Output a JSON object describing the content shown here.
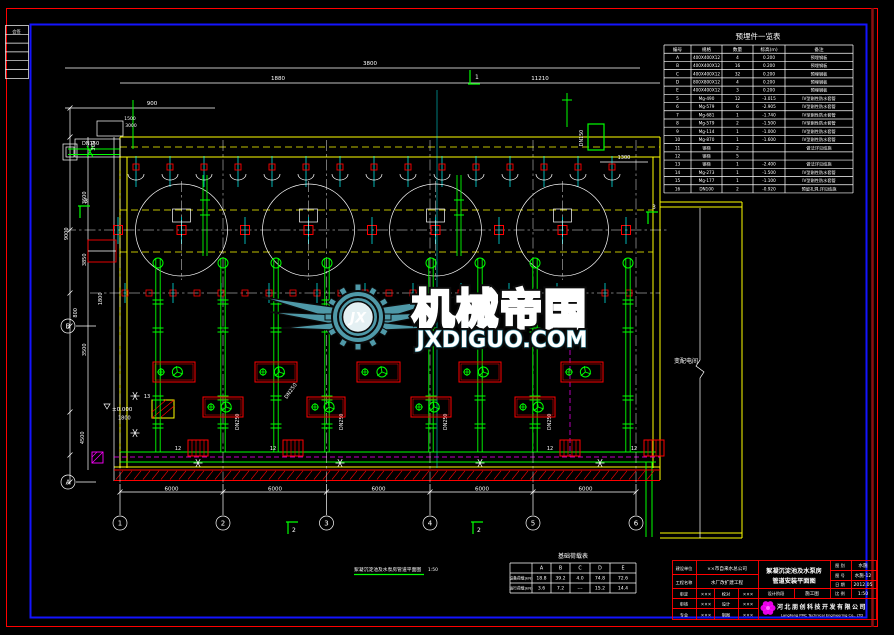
{
  "signoff_strip": {
    "rows": [
      "会签",
      "",
      "",
      "",
      "",
      ""
    ]
  },
  "parts_table": {
    "title": "预埋件一览表",
    "columns": [
      "编号",
      "规格",
      "数量",
      "标高(m)",
      "备注"
    ],
    "rows": [
      [
        "A",
        "400X400X12",
        "4",
        "0.200",
        "预埋钢板"
      ],
      [
        "B",
        "400X400X12",
        "16",
        "0.200",
        "预埋钢板"
      ],
      [
        "C",
        "400X400X12",
        "32",
        "0.200",
        "预埋钢板"
      ],
      [
        "D",
        "800X800X12",
        "4",
        "0.200",
        "预埋钢板"
      ],
      [
        "E",
        "400X400X12",
        "3",
        "0.200",
        "预埋钢板"
      ],
      [
        "5",
        "Mg-490",
        "12",
        "-3.015",
        "IV型刚性防水套管"
      ],
      [
        "6",
        "Mg-579",
        "6",
        "-2.905",
        "IV型刚性防水套管"
      ],
      [
        "7",
        "Mg-681",
        "1",
        "-1.740",
        "IV型刚性防水套管"
      ],
      [
        "8",
        "Mg-579",
        "2",
        "-1.500",
        "IV型刚性防水套管"
      ],
      [
        "9",
        "Mg-114",
        "1",
        "-1.000",
        "IV型刚性防水套管"
      ],
      [
        "10",
        "Mg-870",
        "1",
        "-1.600",
        "IV型刚性防水套管"
      ],
      [
        "11",
        "钢梯",
        "2",
        "",
        "做法详见结施"
      ],
      [
        "12",
        "钢梯",
        "5",
        "",
        ""
      ],
      [
        "13",
        "钢梯",
        "1",
        "-2.400",
        "做法详见结施"
      ],
      [
        "14",
        "Mg-273",
        "1",
        "-1.500",
        "IV型刚性防水套管"
      ],
      [
        "15",
        "Mg-177",
        "1",
        "-1.100",
        "IV型刚性防水套管"
      ],
      [
        "16",
        "DN100",
        "2",
        "-0.920",
        "预留孔洞,详见结施"
      ]
    ]
  },
  "load_table": {
    "title": "基础荷载表",
    "columns": [
      "",
      "A",
      "B",
      "C",
      "D",
      "E"
    ],
    "rows": [
      [
        "设备荷载(kN)",
        "18.8",
        "39.2",
        "4.0",
        "74.8",
        "72.6"
      ],
      [
        "运行荷载(kN)",
        "3.6",
        "7.2",
        "---",
        "15.2",
        "14.4"
      ]
    ]
  },
  "watermark": {
    "brand": "机械帝国",
    "domain": "JXDIGUO.COM",
    "monogram": "JX",
    "color": "#2f8296"
  },
  "drawing": {
    "caption": "絮凝沉淀池及水泵房管道平面图",
    "scale": "1:50",
    "room_label": "变配电间",
    "elevation": "±0.000",
    "elevation_dim": "1800",
    "labels": {
      "inlet_pipe": "DN150",
      "casing_pipe": "DN150",
      "suction_pipe": "DN250",
      "discharge_pipe": "DN250",
      "ladder": "12",
      "stair": "13"
    },
    "dims": {
      "top": "3800",
      "upper_left": "1880",
      "upper_right": "11210",
      "platform": "900",
      "left_small": [
        "1500",
        "3000"
      ],
      "left": [
        "300",
        "3600",
        "9000",
        "3850",
        "1800",
        "800",
        "3500",
        "4500"
      ],
      "right": "1300",
      "bottom": [
        "6000",
        "6000",
        "6000",
        "6000",
        "6000"
      ]
    },
    "grid": {
      "bottom": [
        "1",
        "2",
        "3",
        "4",
        "5",
        "6"
      ],
      "left": [
        "B",
        "A"
      ]
    },
    "sections": [
      "1",
      "2",
      "3"
    ]
  },
  "title_block": {
    "client_label": "建设单位",
    "client": "××市自来水总公司",
    "project_label": "工程名称",
    "project": "水厂改扩建工程",
    "roles": [
      [
        "审定",
        "×××",
        "校对",
        "×××"
      ],
      [
        "审核",
        "×××",
        "设计",
        "×××"
      ],
      [
        "专业",
        "×××",
        "制图",
        "×××"
      ]
    ],
    "drawing_title_1": "絮凝沉淀池及水泵房",
    "drawing_title_2": "管道安装平面图",
    "stage_label": "设计阶段",
    "stage": "施工图",
    "fig_type_label": "图 别",
    "fig_type": "水施",
    "fig_no_label": "图 号",
    "fig_no": "水施-12",
    "date_label": "日 期",
    "date": "2012.05",
    "scale_label": "比 例",
    "scale": "1:50",
    "company": "河北朋创科技开发有限公司",
    "company_en": "LangFang PMC Technical Engineering Co., LTD"
  }
}
